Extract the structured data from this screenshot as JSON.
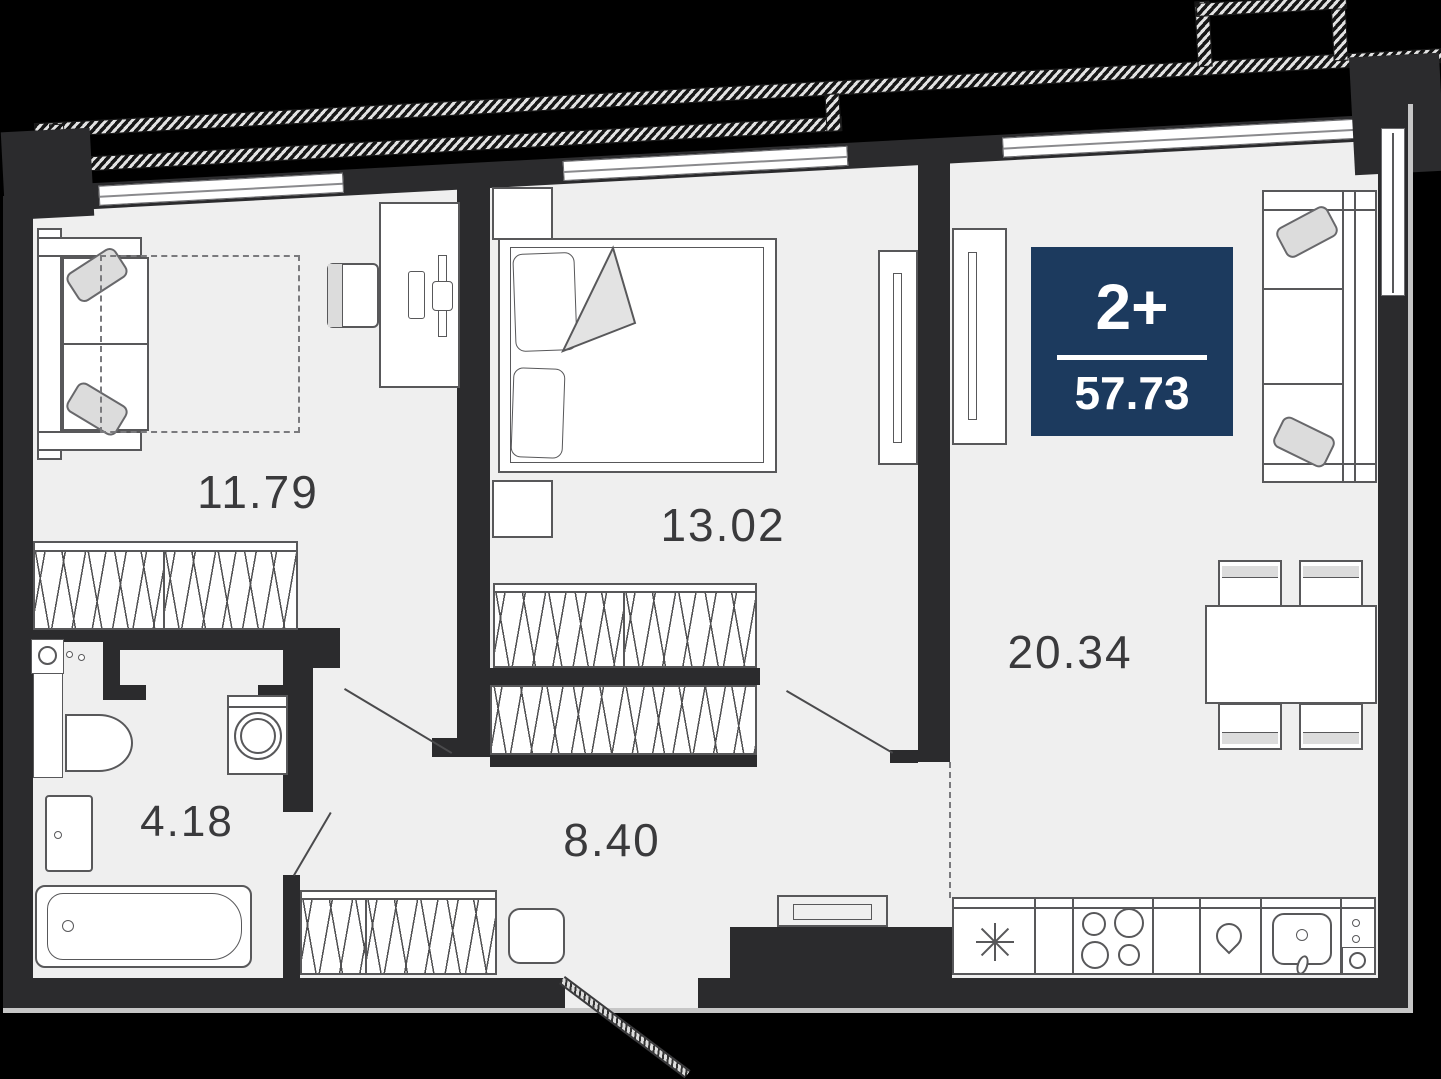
{
  "plan": {
    "badge": {
      "rooms_label": "2+",
      "area_total": "57.73",
      "color": "#1c3a5e"
    },
    "rooms": [
      {
        "id": "room-1",
        "area": "11.79"
      },
      {
        "id": "bedroom",
        "area": "13.02"
      },
      {
        "id": "kitchen-living",
        "area": "20.34"
      },
      {
        "id": "hallway",
        "area": "8.40"
      },
      {
        "id": "bathroom",
        "area": "4.18"
      }
    ],
    "icons": [
      "sofa",
      "desk",
      "desk-chair",
      "double-bed",
      "nightstand",
      "sliding-wardrobe",
      "wardrobe-hatch",
      "toilet",
      "sink",
      "washing-machine",
      "bathroom-cabinet",
      "bathtub",
      "pouf",
      "doormat",
      "dining-table",
      "chair",
      "fridge-snowflake",
      "stove-burners",
      "kitchen-sink",
      "balcony-railing",
      "door-swing",
      "entrance-door"
    ],
    "colors": {
      "background": "#000000",
      "wall": "#2b2b2d",
      "floor": "#efefef",
      "furniture_stroke": "#58585a",
      "pillow": "#dcdcdc",
      "label": "#3a3a3c",
      "badge": "#1c3a5e"
    }
  }
}
